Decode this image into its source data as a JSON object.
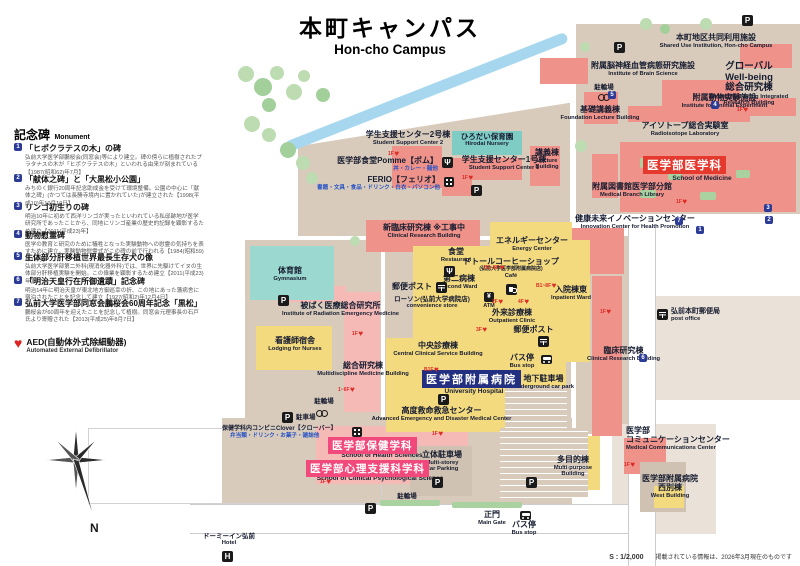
{
  "title": {
    "jp": "本町キャンパス",
    "en": "Hon-cho Campus"
  },
  "compass": {
    "north": "N"
  },
  "footer": {
    "scale": "S : 1/2,000",
    "note": "掲載されている情報は、2026年3月現在のものです"
  },
  "icons": {
    "parking": "P",
    "atm_yen": "¥",
    "fork": "Ψ",
    "hotel": "H",
    "heart": "♥",
    "info": "i"
  },
  "legend": {
    "heading_jp": "記念碑",
    "heading_en": "Monument",
    "monuments": [
      {
        "num": "1",
        "title": "「ヒポクラテスの木」の碑",
        "desc": "弘前大学医学部鵬桜会(同窓会)等により建立。碑の傍らに植樹されたプラタナスの木が「ヒポクラテスの木」といわれる由来が刻まれている【1987(昭和62)年7月】"
      },
      {
        "num": "2",
        "title": "「献体之碑」と「大黒松小公園」",
        "desc": "みちのく銀行20周年記念助成金を受けて環境整備。公園の中心に「献体之碑」(かつては長勝寺境内に置かれていた)が建立された【1998(平成10)年10月19日】"
      },
      {
        "num": "3",
        "title": "リンゴ初生りの碑",
        "desc": "明治10年に初めて西洋リンゴが実ったといわれている私邸跡地が医学研究所であったことから、同地にリンゴ産業の歴史的記録を顕彰するため建立【2011(平成23)年】"
      },
      {
        "num": "4",
        "title": "動物慰霊碑",
        "desc": "医学の教育と研究のために犠牲となった実験動物への慰霊の気持ちを表すために建立。実験動物慰霊式がこの碑の前で行われる【1984(昭和59)年10月】"
      },
      {
        "num": "5",
        "title": "生体部分肝移植世界最長生存犬の像",
        "desc": "弘前大学医学部第二外科(現消化器外科)では、世界に先駆けてイヌの生体部分肝移植実験を開始。この偉業を顕彰するため建立【2011(平成23)年】"
      },
      {
        "num": "6",
        "title": "「明治天皇行在所御遺蹟」記念碑",
        "desc": "明治14年に明治天皇が東北地方御巡幸の折、この地にあった藩病舎に宿泊されたことを記念して建立【1927(昭和2)年12月4日】"
      },
      {
        "num": "7",
        "title": "弘前大学医学部同窓会鵬桜会60周年記念「黒松」",
        "desc": "鵬桜会が60周年を迎えたことを記念して植樹。同窓会元理事長の石戸氏より寄贈された【2013(平成25)年8月7日】"
      }
    ],
    "aed": {
      "jp": "AED(自動体外式除細動器)",
      "en": "Automated External Defibrillator"
    }
  },
  "map": {
    "aed_floors": [
      "1F",
      "1F",
      "1F",
      "1F",
      "1F",
      "1~6F",
      "B1~8F",
      "2F",
      "4F",
      "3F",
      "B1~8F",
      "1F",
      "1F",
      "1F",
      "1F",
      "B1F"
    ],
    "labels": {
      "shared_use": {
        "jp": "本町地区共同利用施設",
        "en": "Shared Use Institution, Hon-cho Campus"
      },
      "global_wellbeing": {
        "jp": "グローバル\nWell-being\n総合研究棟",
        "en": "Global Well-being Integrated\nResearch Building"
      },
      "brain": {
        "jp": "附属脳神経血管病態研究施設",
        "en": "Institute of Brain Science"
      },
      "bike_top": {
        "jp": "駐輪場"
      },
      "animal": {
        "jp": "附属動物実験施設",
        "en": "Institute for Animal Experiment"
      },
      "foundation_lecture": {
        "jp": "基礎講義棟",
        "en": "Foundation Lecture Building"
      },
      "radioisotope": {
        "jp": "アイソトープ総合実験室",
        "en": "Radioisotope Laboratory"
      },
      "med_library": {
        "jp": "附属図書館医学部分館",
        "en": "Medical Branch Library"
      },
      "school_of_medicine": {
        "jp": "医学部医学科",
        "en": "School of Medicine"
      },
      "lecture": {
        "jp": "講義棟",
        "en": "Lecture\nBuilding"
      },
      "ssc2": {
        "jp": "学生支援センター2号棟",
        "en": "Student Support Center 2"
      },
      "nursery": {
        "jp": "ひろだい保育園",
        "en": "Hirodai Nursery"
      },
      "pomme": {
        "jp": "医学部食堂Pomme【ポム】",
        "sub": "丼・カレー・麺他"
      },
      "ferio": {
        "jp": "FERIO【フェリオ】",
        "sub": "書籍・文具・食品・ドリンク・白衣・パソコン他"
      },
      "ssc1": {
        "jp": "学生支援センター1号棟",
        "en": "Student Support Center 1"
      },
      "new_clinical": {
        "jp": "新臨床研究棟 ※工事中",
        "en": "Clinical Research Building"
      },
      "energy": {
        "jp": "エネルギーセンター",
        "en": "Energy Center"
      },
      "innovation": {
        "jp": "健康未来イノベーションセンター",
        "en": "Innovation Center for Health Promotion"
      },
      "restaurant": {
        "jp": "食堂",
        "en": "Restaurant"
      },
      "doutor": {
        "jp": "ドトールコーヒーショップ",
        "sub2": "(弘前大学医学部附属病院店)",
        "en": "Café"
      },
      "second_ward": {
        "jp": "第二病棟",
        "en": "Second Ward"
      },
      "postbox1": {
        "jp": "郵便ポスト"
      },
      "lawson": {
        "jp": "ローソン(弘前大学病院店)",
        "en": "convenience store"
      },
      "gym": {
        "jp": "体育館",
        "en": "Gymnasium"
      },
      "inpatient": {
        "jp": "入院棟東",
        "en": "Inpatient Ward"
      },
      "outpatient": {
        "jp": "外来診療棟",
        "en": "Outpatient Clinic"
      },
      "atm": {
        "jp": "ATM"
      },
      "postbox2": {
        "jp": "郵便ポスト"
      },
      "radiation": {
        "jp": "被ばく医療総合研究所",
        "en": "Institute of Radiation Emergency Medicine"
      },
      "nurses": {
        "jp": "看護師宿舎",
        "en": "Lodging for Nurses"
      },
      "multidiscipline": {
        "jp": "総合研究棟",
        "en": "Multidiscipline Medicine Building"
      },
      "central_clinical": {
        "jp": "中央診療棟",
        "en": "Central Clinical Service Building"
      },
      "hospital": {
        "jp": "医学部附属病院",
        "en": "University Hospital"
      },
      "advanced_emergency": {
        "jp": "高度救命救急センター",
        "en": "Advanced Emergency and Disaster Medical Center"
      },
      "bus1": {
        "jp": "バス停",
        "en": "Bus stop"
      },
      "underground": {
        "jp": "地下駐車場",
        "en": "Underground car park"
      },
      "clinical_research": {
        "jp": "臨床研究棟",
        "en": "Clinical Research Building"
      },
      "post_office": {
        "jp": "弘前本町郵便局",
        "en": "post office"
      },
      "bike2": {
        "jp": "駐輪場"
      },
      "parking2": {
        "jp": "駐車場"
      },
      "clover": {
        "jp": "保健学科内コンビニClover【クローバー】",
        "sub": "弁当類・ドリンク・お菓子・雑誌他"
      },
      "health_sciences": {
        "jp": "医学部保健学科",
        "en": "School of Health Sciences"
      },
      "psychology": {
        "jp": "医学部心理支援科学科",
        "en": "School of Clinical Psychological Science"
      },
      "multistorey": {
        "jp": "立体駐車場",
        "en": "Multi-storey\nCar Parking"
      },
      "bike3": {
        "jp": "駐輪場"
      },
      "main_gate": {
        "jp": "正門",
        "en": "Main Gate"
      },
      "bus2": {
        "jp": "バス停",
        "en": "Bus stop"
      },
      "multipurpose": {
        "jp": "多目的棟",
        "en": "Multi-purpose\nBuilding"
      },
      "comm_center": {
        "jp": "医学部\nコミュニケーションセンター",
        "en": "Medical Communications Center"
      },
      "west_building": {
        "jp": "医学部附属病院\n西別棟",
        "en": "West Building"
      },
      "hotel": {
        "jp": "ドーミーイン弘前",
        "en": "Hotel"
      }
    }
  }
}
